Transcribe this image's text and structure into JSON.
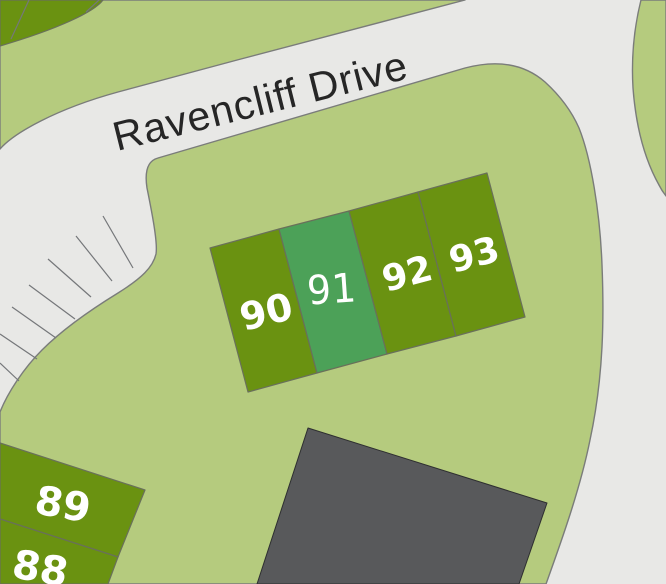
{
  "map": {
    "street": {
      "label": "Ravencliff Drive"
    },
    "plots": [
      {
        "id": "plot-88",
        "label": "88",
        "highlighted": false
      },
      {
        "id": "plot-89",
        "label": "89",
        "highlighted": false
      },
      {
        "id": "plot-90",
        "label": "90",
        "highlighted": false
      },
      {
        "id": "plot-91",
        "label": "91",
        "highlighted": true
      },
      {
        "id": "plot-92",
        "label": "92",
        "highlighted": false
      },
      {
        "id": "plot-93",
        "label": "93",
        "highlighted": false
      }
    ],
    "colors": {
      "road": "#e8e8e6",
      "land": "#b5cb7e",
      "plot": "#6a9211",
      "plot_highlight": "#4ca158",
      "building": "#58595b",
      "label_text": "#ffffff",
      "street_text": "#262626"
    }
  }
}
